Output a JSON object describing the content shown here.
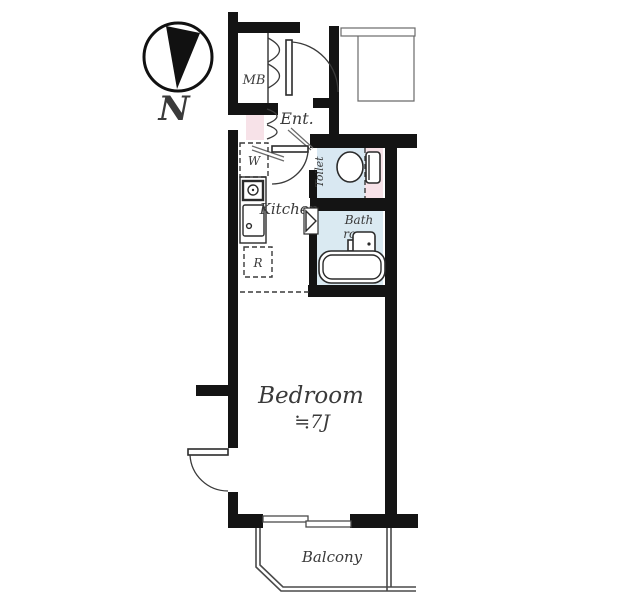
{
  "compass": {
    "label": "N"
  },
  "rooms": {
    "meter_box": {
      "label": "MB"
    },
    "entrance": {
      "label": "Ent."
    },
    "washer_space": {
      "label": "W"
    },
    "kitchen": {
      "label": "Kitchen"
    },
    "refrigerator_space": {
      "label": "R"
    },
    "toilet": {
      "label": "Toilet"
    },
    "bathroom": {
      "label_line1": "Bath",
      "label_line2": "room"
    },
    "bedroom": {
      "label": "Bedroom",
      "size": "≒7J"
    },
    "balcony": {
      "label": "Balcony"
    }
  },
  "colors": {
    "wall": "#141414",
    "toilet_floor": "#d9e8f2",
    "bathroom_floor": "#daeaf2",
    "accent_pink": "#f7e2e8",
    "compass": "#111111"
  }
}
